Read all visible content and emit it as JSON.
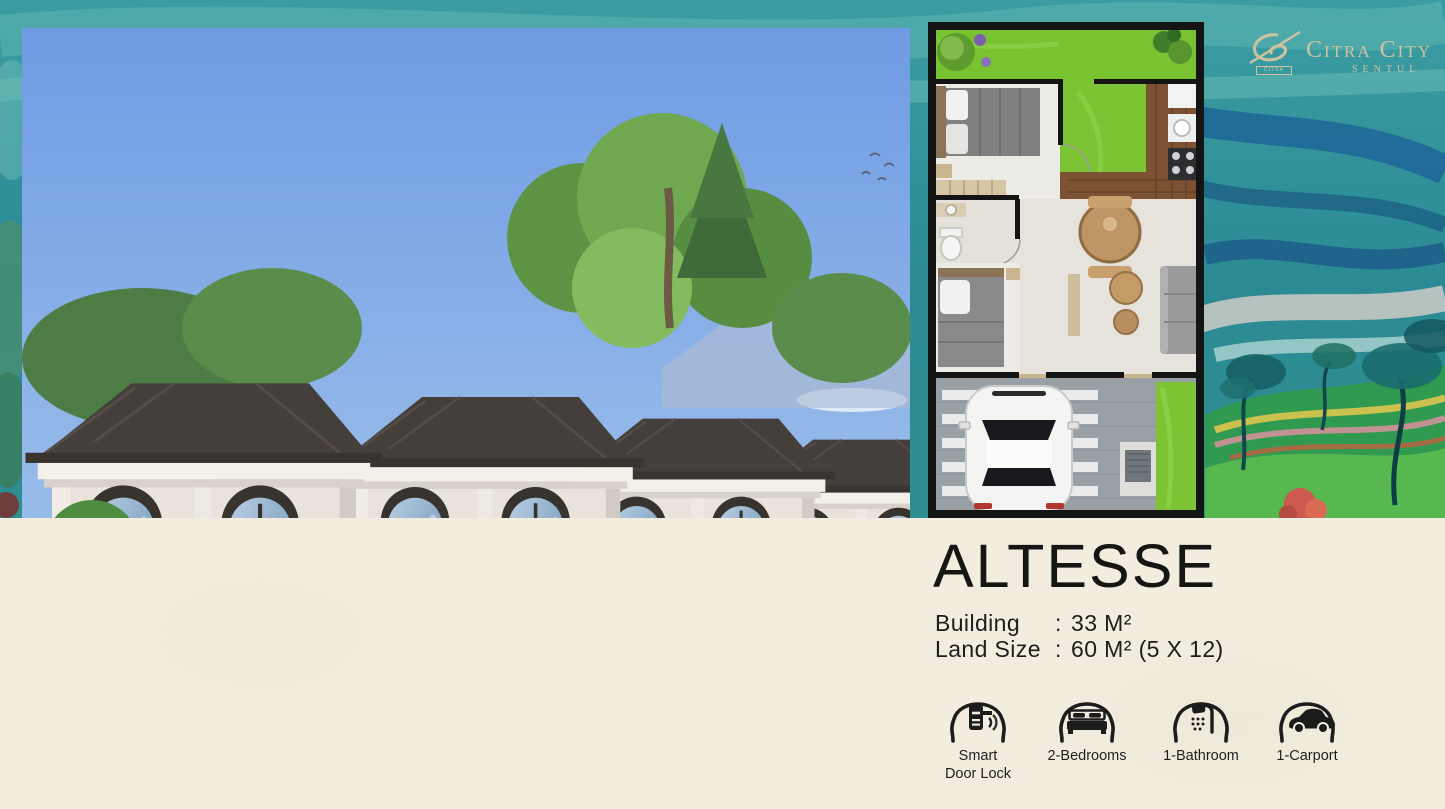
{
  "brand": {
    "name": "Citra City",
    "sub_name": "SENTUL",
    "logo_mark_text": "CITRA",
    "logo_color": "#cfc2a0"
  },
  "product": {
    "name": "ALTESSE",
    "specs": [
      {
        "label": "Building",
        "sep": ":",
        "value": "33 M²"
      },
      {
        "label": "Land Size",
        "sep": ":",
        "value": "60 M² (5 X 12)"
      }
    ]
  },
  "features": [
    {
      "icon": "smart-door-lock-icon",
      "label": "Smart Door Lock"
    },
    {
      "icon": "bed-icon",
      "label": "2-Bedrooms"
    },
    {
      "icon": "shower-icon",
      "label": "1-Bathroom"
    },
    {
      "icon": "car-icon",
      "label": "1-Carport"
    }
  ],
  "images": {
    "hero": "exterior-render-row-of-classic-white-houses-with-blue-car-and-people",
    "floorplan": "altesse-2-bedroom-floor-plan-top-view"
  },
  "colors": {
    "panel_cream": "#f2eddf",
    "paint_teal": "#2f8f99",
    "paint_blue_swirl": "#1c5f97",
    "paint_green_hill": "#2f9a50",
    "text_dark": "#1d1d1b",
    "roof_dark": "#453f3b",
    "wall_cream": "#e9e3dc",
    "car_blue": "#6e93b7"
  }
}
